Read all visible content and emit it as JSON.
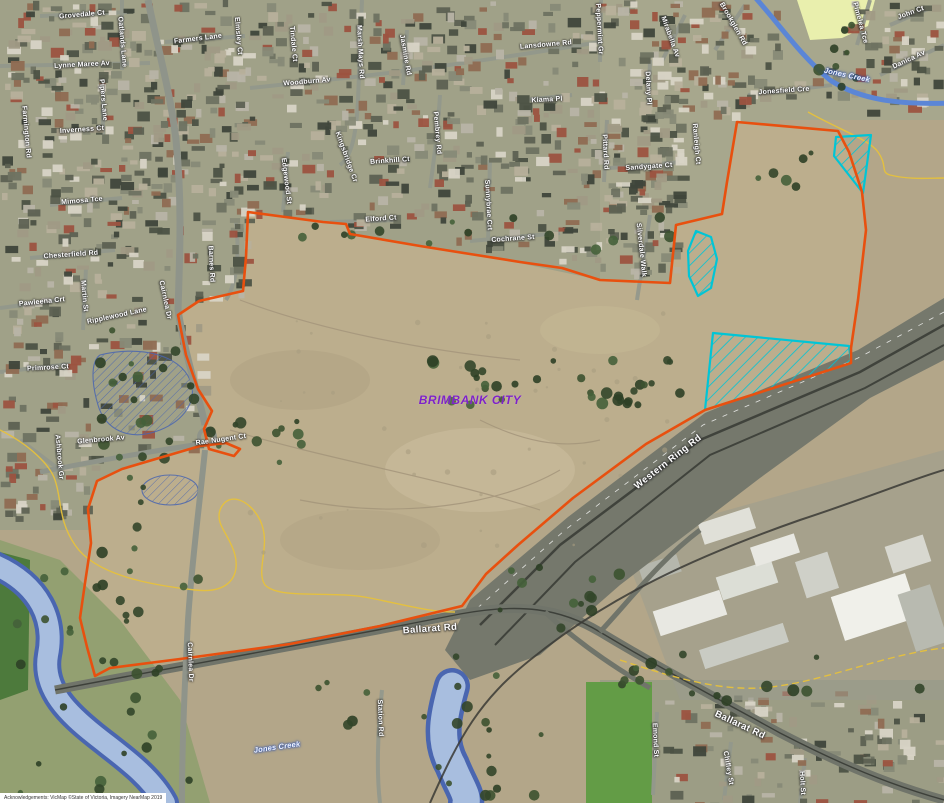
{
  "map": {
    "municipality_label": "BRIMBANK CITY",
    "attribution": "Acknowledgements: VicMap ©State of Victoria, Imagery NearMap 2019",
    "colors": {
      "site_boundary_orange": "#e8500f",
      "overlay_hatch_cyan": "#00c5d6",
      "municipality_purple": "#7e22c8",
      "easement_yellow": "#e6c13c",
      "water_outline_blue": "#4a66b0",
      "water_fill_blue": "#a8bedf"
    },
    "labels": [
      {
        "t": "Grovedale Ct",
        "x": 82,
        "y": 15,
        "r": -5,
        "c": "s"
      },
      {
        "t": "Farmers Lane",
        "x": 198,
        "y": 39,
        "r": -7,
        "c": "s"
      },
      {
        "t": "Oatlands Lane",
        "x": 122,
        "y": 42,
        "r": 85,
        "c": "s"
      },
      {
        "t": "Lynne Maree Av",
        "x": 82,
        "y": 65,
        "r": -3,
        "c": "s"
      },
      {
        "t": "Elmsley Ct",
        "x": 238,
        "y": 36,
        "r": 85,
        "c": "s"
      },
      {
        "t": "Tindale Ct",
        "x": 293,
        "y": 44,
        "r": 85,
        "c": "s"
      },
      {
        "t": "Pipers Lane",
        "x": 103,
        "y": 100,
        "r": 85,
        "c": "s"
      },
      {
        "t": "Farmington Rd",
        "x": 26,
        "y": 132,
        "r": 85,
        "c": "s"
      },
      {
        "t": "Inverness Ct",
        "x": 82,
        "y": 130,
        "r": -4,
        "c": "s"
      },
      {
        "t": "Woodburn Av",
        "x": 307,
        "y": 82,
        "r": -5,
        "c": "s"
      },
      {
        "t": "Marsh Mays Rd",
        "x": 360,
        "y": 52,
        "r": 87,
        "c": "s"
      },
      {
        "t": "Jasmine Rd",
        "x": 405,
        "y": 55,
        "r": 80,
        "c": "s"
      },
      {
        "t": "Pembrey Rd",
        "x": 437,
        "y": 133,
        "r": 85,
        "c": "s"
      },
      {
        "t": "Brinkhill Ct",
        "x": 390,
        "y": 161,
        "r": -4,
        "c": "s"
      },
      {
        "t": "Kingsbridge Cr",
        "x": 346,
        "y": 157,
        "r": 70,
        "c": "s"
      },
      {
        "t": "Elford Ct",
        "x": 381,
        "y": 219,
        "r": -4,
        "c": "s"
      },
      {
        "t": "Sunnybrae Crt",
        "x": 488,
        "y": 205,
        "r": 87,
        "c": "s"
      },
      {
        "t": "Cochrane St",
        "x": 513,
        "y": 239,
        "r": -4,
        "c": "s"
      },
      {
        "t": "Mimosa Tce",
        "x": 82,
        "y": 201,
        "r": -5,
        "c": "s"
      },
      {
        "t": "Chesterfield Rd",
        "x": 71,
        "y": 255,
        "r": -4,
        "c": "s"
      },
      {
        "t": "Martin St",
        "x": 84,
        "y": 296,
        "r": 85,
        "c": "s"
      },
      {
        "t": "Edgewood St",
        "x": 286,
        "y": 181,
        "r": 83,
        "c": "s"
      },
      {
        "t": "Pawleena Crt",
        "x": 42,
        "y": 302,
        "r": -6,
        "c": "s"
      },
      {
        "t": "Primrose Ct",
        "x": 48,
        "y": 368,
        "r": -3,
        "c": "s"
      },
      {
        "t": "Ripplewood Lane",
        "x": 117,
        "y": 316,
        "r": -12,
        "c": "s"
      },
      {
        "t": "Cairnlea Dr",
        "x": 165,
        "y": 300,
        "r": 78,
        "c": "s"
      },
      {
        "t": "Barnes Rd",
        "x": 211,
        "y": 264,
        "r": 87,
        "c": "s"
      },
      {
        "t": "Glenbrook Av",
        "x": 101,
        "y": 440,
        "r": -5,
        "c": "s"
      },
      {
        "t": "Ashbrook Gr",
        "x": 59,
        "y": 457,
        "r": 85,
        "c": "s"
      },
      {
        "t": "Rae Nugent Ct",
        "x": 221,
        "y": 440,
        "r": -8,
        "c": "s"
      },
      {
        "t": "Lansdowne Rd",
        "x": 546,
        "y": 45,
        "r": -5,
        "c": "s"
      },
      {
        "t": "Peppermint Gr",
        "x": 599,
        "y": 29,
        "r": 87,
        "c": "s"
      },
      {
        "t": "Kiama Pl",
        "x": 547,
        "y": 100,
        "r": -3,
        "c": "s"
      },
      {
        "t": "Delany Pl",
        "x": 648,
        "y": 88,
        "r": 87,
        "c": "s"
      },
      {
        "t": "Mirabella Av",
        "x": 670,
        "y": 37,
        "r": 70,
        "c": "s"
      },
      {
        "t": "Pittard Rd",
        "x": 605,
        "y": 152,
        "r": 87,
        "c": "s"
      },
      {
        "t": "Sandygate Ct",
        "x": 649,
        "y": 167,
        "r": -4,
        "c": "s"
      },
      {
        "t": "Ranleigh Ct",
        "x": 696,
        "y": 144,
        "r": 85,
        "c": "s"
      },
      {
        "t": "Silverdale Walk",
        "x": 641,
        "y": 250,
        "r": 84,
        "c": "s"
      },
      {
        "t": "Brookglen Rd",
        "x": 733,
        "y": 24,
        "r": 60,
        "c": "s"
      },
      {
        "t": "Jonesfield Cre",
        "x": 784,
        "y": 91,
        "r": -4,
        "c": "s"
      },
      {
        "t": "Pimelea Tce",
        "x": 860,
        "y": 23,
        "r": 75,
        "c": "s"
      },
      {
        "t": "John Ct",
        "x": 911,
        "y": 13,
        "r": -20,
        "c": "s"
      },
      {
        "t": "Danica Av",
        "x": 909,
        "y": 60,
        "r": -25,
        "c": "s"
      },
      {
        "t": "Station Rd",
        "x": 380,
        "y": 718,
        "r": 88,
        "c": "s"
      },
      {
        "t": "Cairnlea Dr",
        "x": 190,
        "y": 662,
        "r": 88,
        "c": "s"
      },
      {
        "t": "Emond St",
        "x": 655,
        "y": 740,
        "r": 87,
        "c": "s"
      },
      {
        "t": "Chifley St",
        "x": 728,
        "y": 768,
        "r": 80,
        "c": "s"
      },
      {
        "t": "Holt St",
        "x": 802,
        "y": 783,
        "r": 87,
        "c": "s"
      },
      {
        "t": "Ballarat Rd",
        "x": 430,
        "y": 629,
        "r": -4,
        "c": "road"
      },
      {
        "t": "Ballarat Rd",
        "x": 740,
        "y": 725,
        "r": 25,
        "c": "road"
      },
      {
        "t": "Western Ring Rd",
        "x": 668,
        "y": 462,
        "r": -38,
        "c": "road"
      },
      {
        "t": "BRIMBANK CITY",
        "x": 470,
        "y": 400,
        "r": 0,
        "c": "city"
      },
      {
        "t": "Jones Creek",
        "x": 847,
        "y": 75,
        "r": 12,
        "c": "water"
      },
      {
        "t": "Jones Creek",
        "x": 277,
        "y": 747,
        "r": -8,
        "c": "water"
      }
    ]
  }
}
